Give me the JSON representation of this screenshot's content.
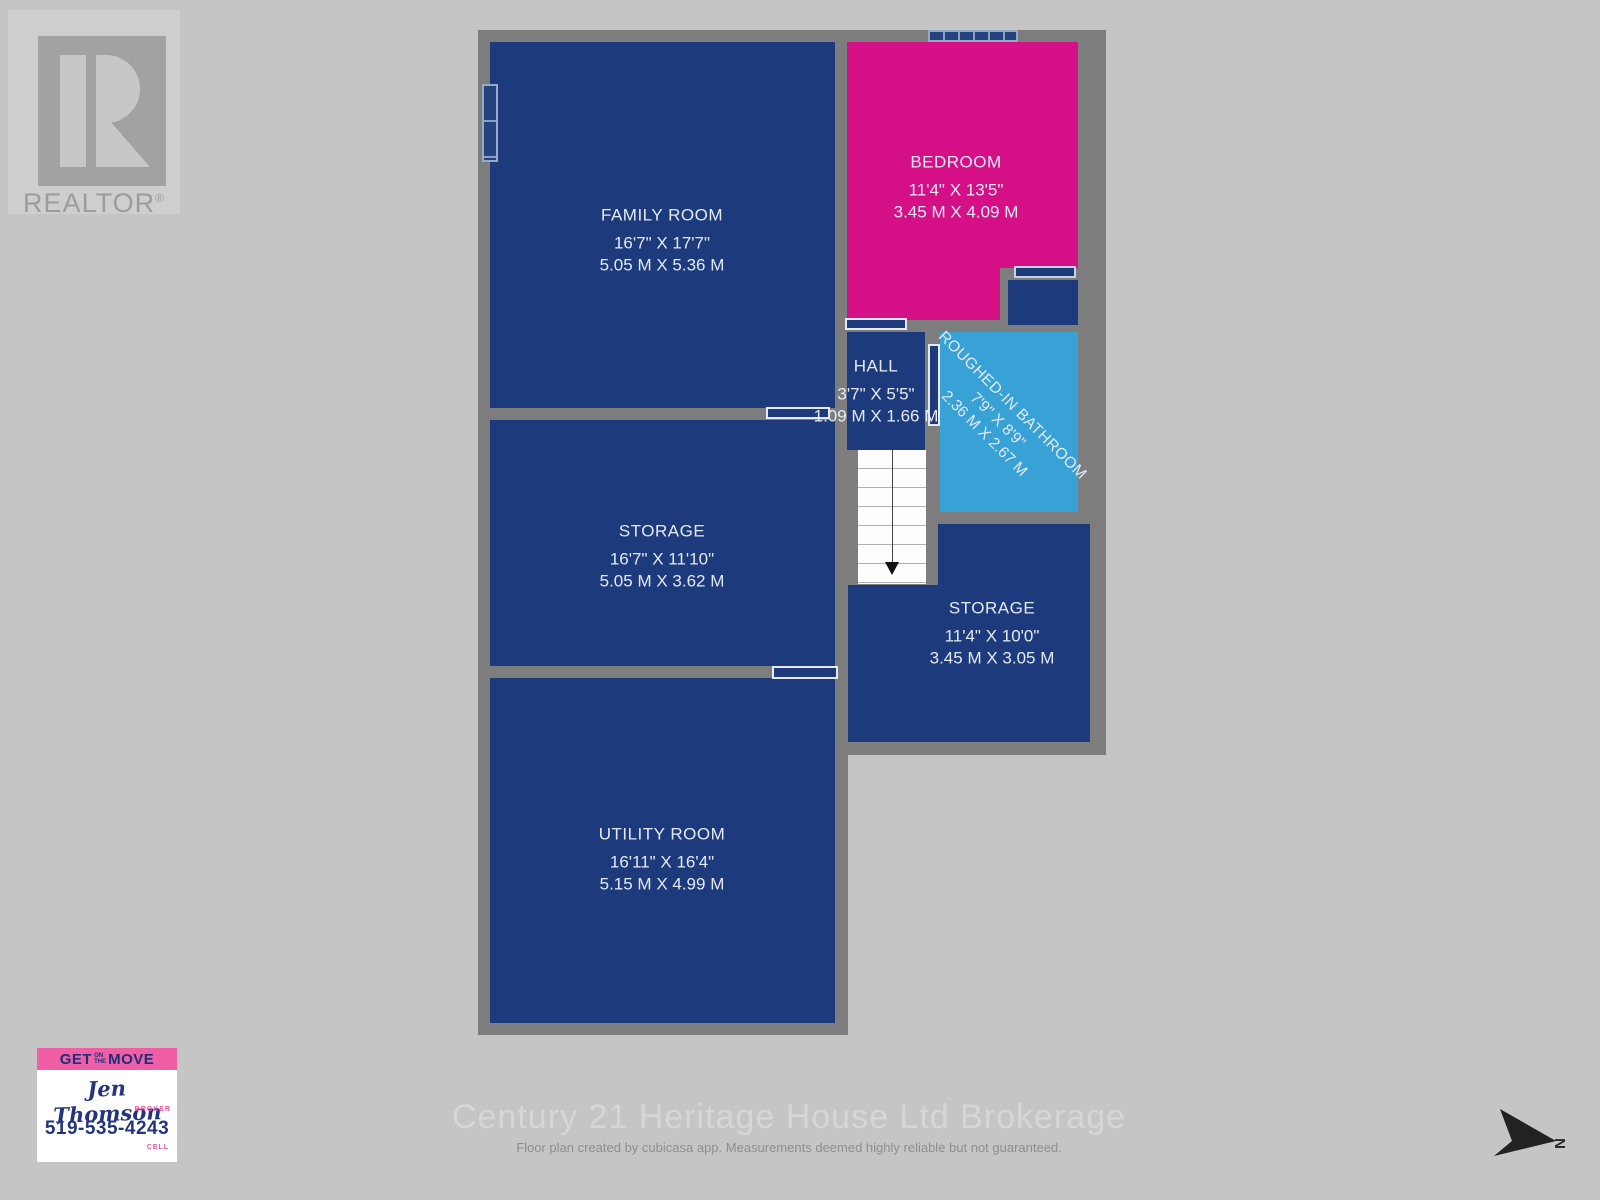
{
  "realtor": {
    "label": "REALTOR",
    "reg": "®"
  },
  "floorplan": {
    "rooms": [
      {
        "id": "family-room",
        "name": "FAMILY ROOM",
        "dim_ft": "16'7\" X 17'7\"",
        "dim_m": "5.05 M X 5.36 M",
        "color": "#1d3b7c"
      },
      {
        "id": "bedroom",
        "name": "BEDROOM",
        "dim_ft": "11'4\" X 13'5\"",
        "dim_m": "3.45 M X 4.09 M",
        "color": "#d50f86"
      },
      {
        "id": "hall",
        "name": "HALL",
        "dim_ft": "3'7\" X 5'5\"",
        "dim_m": "1.09 M X 1.66 M",
        "color": "#1d3b7c"
      },
      {
        "id": "roughed-in-bathroom",
        "name": "ROUGHED-IN BATHROOM",
        "dim_ft": "7'9\" X 8'9\"",
        "dim_m": "2.36 M X 2.67 M",
        "color": "#38a2d7"
      },
      {
        "id": "storage-left",
        "name": "STORAGE",
        "dim_ft": "16'7\" X 11'10\"",
        "dim_m": "5.05 M X 3.62 M",
        "color": "#1d3b7c"
      },
      {
        "id": "storage-right",
        "name": "STORAGE",
        "dim_ft": "11'4\" X 10'0\"",
        "dim_m": "3.45 M X 3.05 M",
        "color": "#1d3b7c"
      },
      {
        "id": "utility-room",
        "name": "UTILITY ROOM",
        "dim_ft": "16'11\" X 16'4\"",
        "dim_m": "5.15 M X 4.99 M",
        "color": "#1d3b7c"
      }
    ],
    "wall_color": "#7d7d7d",
    "background_color": "#c5c5c5"
  },
  "agent": {
    "banner_get": "GET",
    "banner_on": "ON",
    "banner_the": "THE",
    "banner_move": "MOVE",
    "name": "Jen Thomson",
    "title": "BROKER",
    "phone": "519-535-4243",
    "phone_label": "CELL",
    "banner_color": "#f05fa5",
    "text_color": "#24357f"
  },
  "footer": {
    "brokerage": "Century 21 Heritage House Ltd Brokerage",
    "disclaimer": "Floor plan created by cubicasa app. Measurements deemed highly reliable but not guaranteed."
  },
  "compass": {
    "label": "N"
  }
}
